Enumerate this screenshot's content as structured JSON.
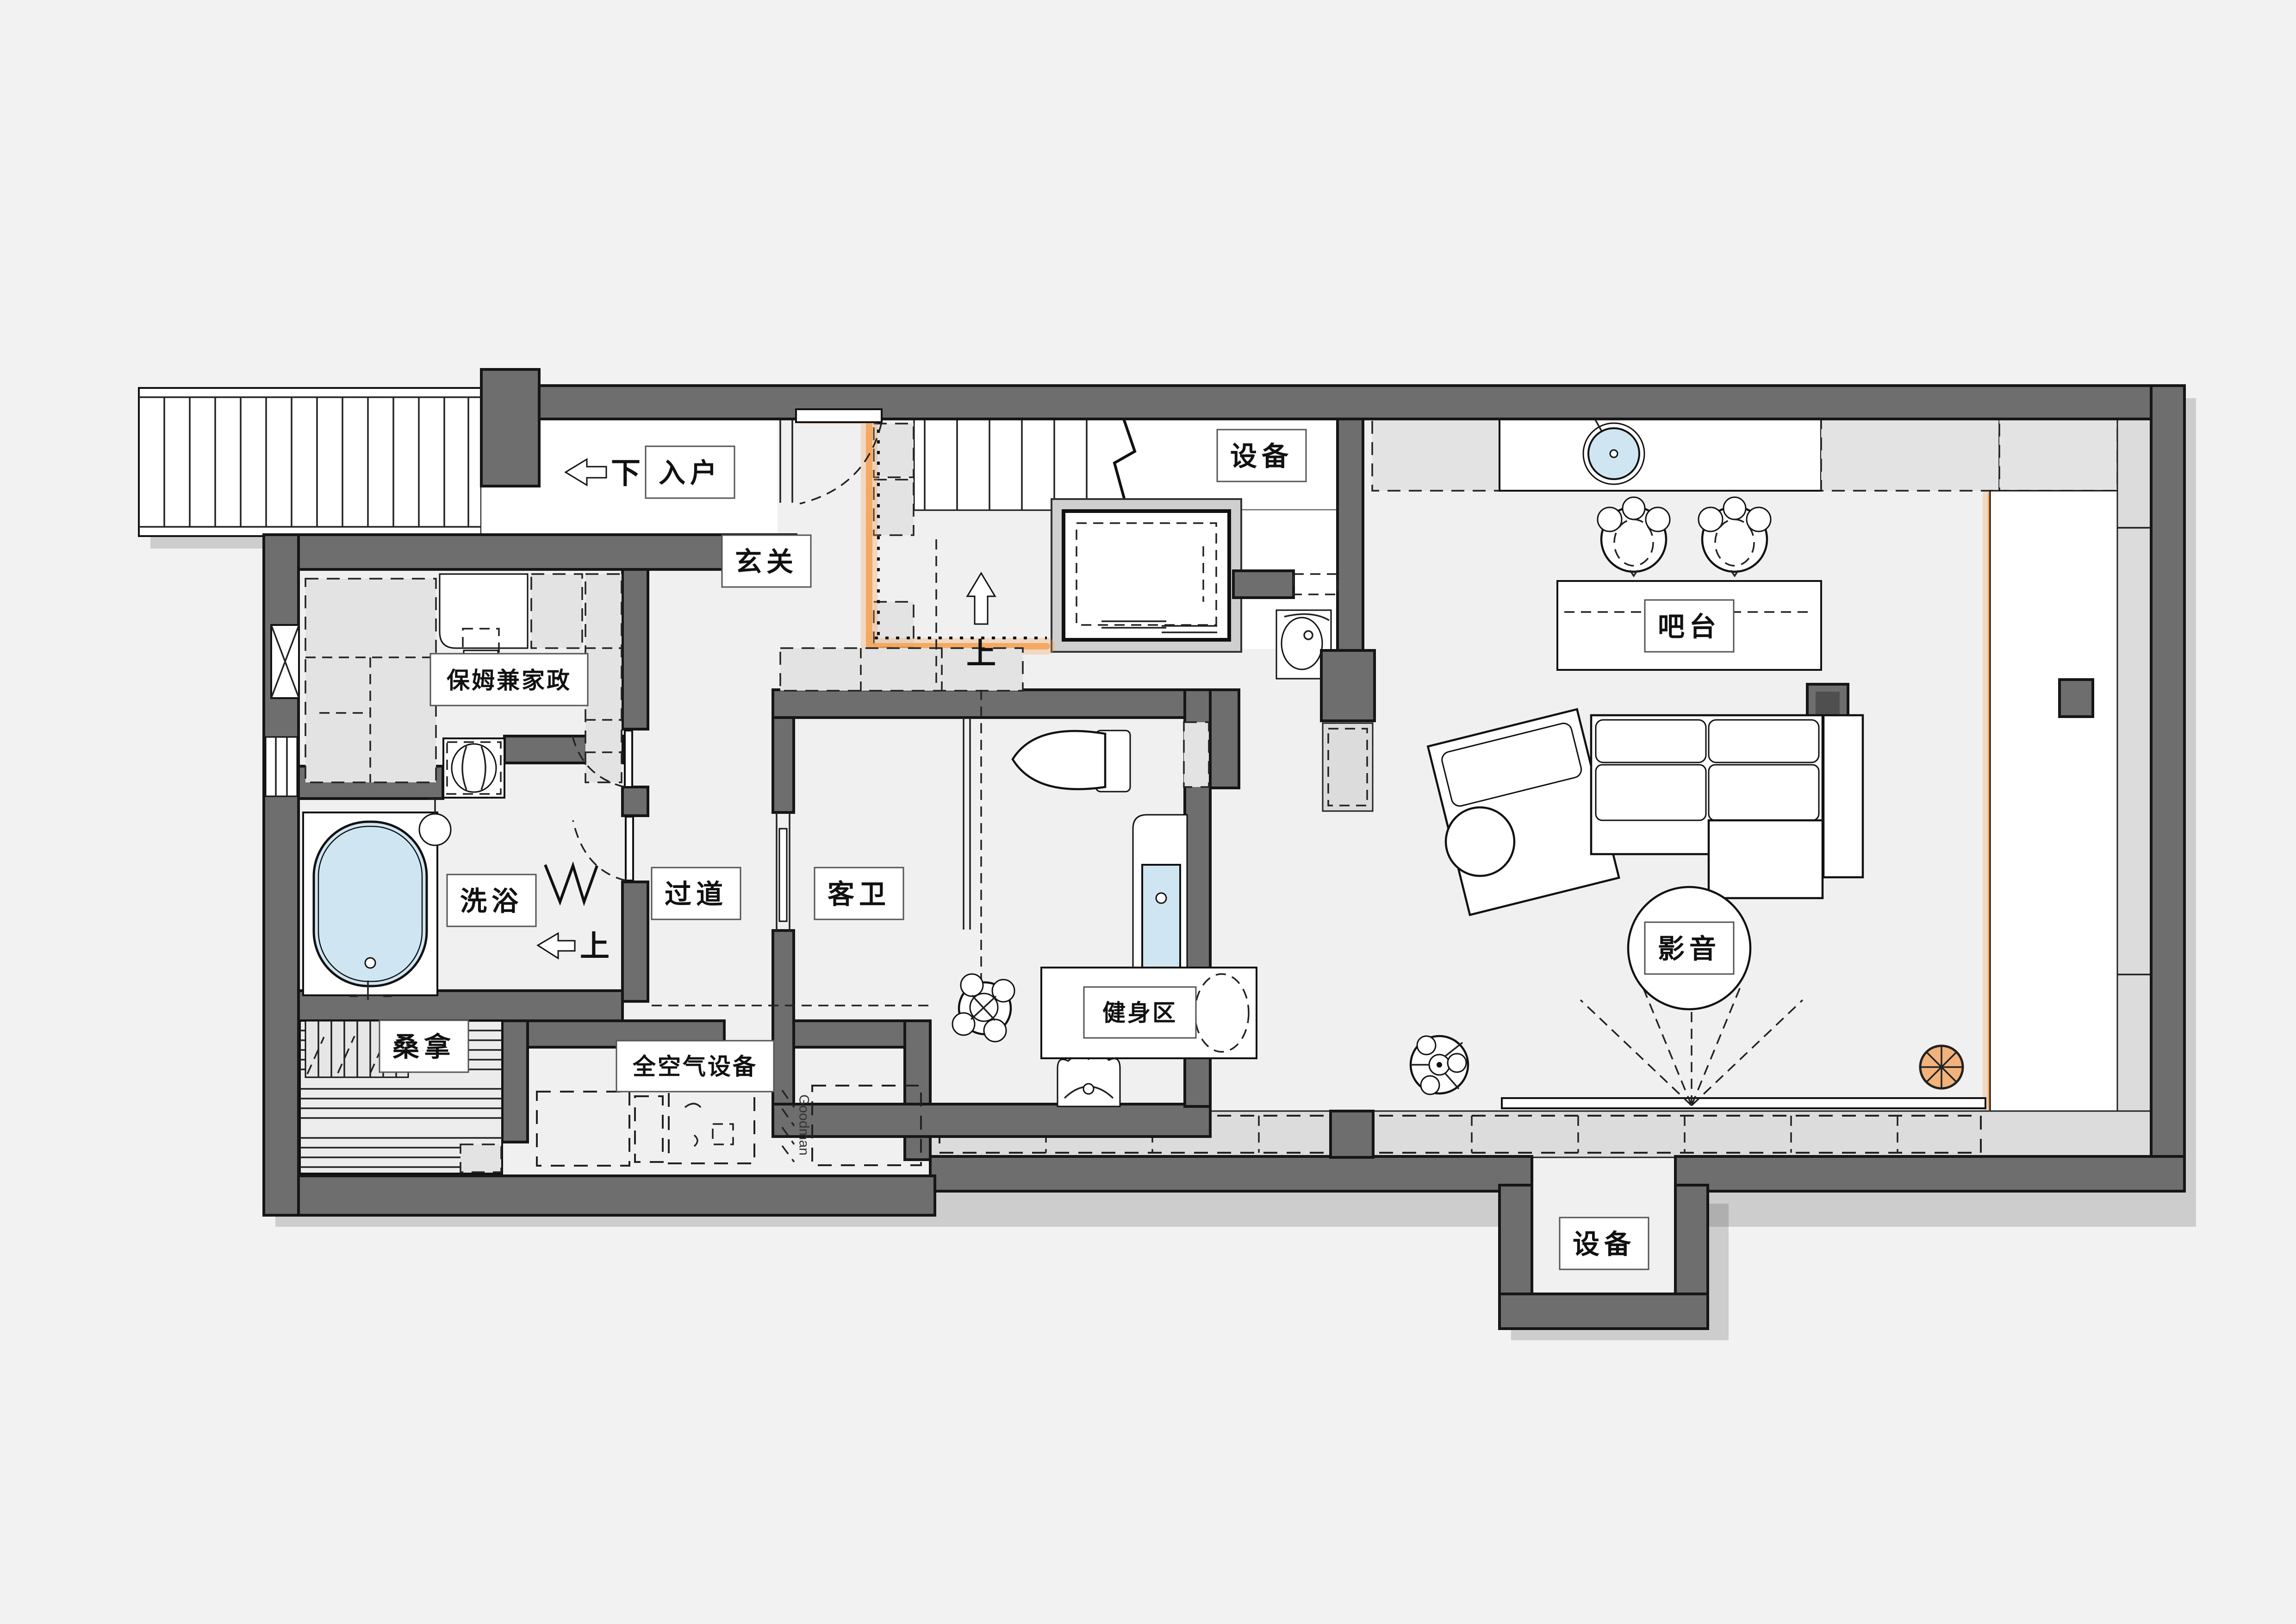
{
  "plan": {
    "type": "residential basement floor plan",
    "colors": {
      "wall_grey": "#6e6e6e",
      "accent_orange": "#f4a254",
      "water_blue": "#cfe6f2",
      "floor_grey": "#f0f0f1",
      "cabinet_grey": "#e3e3e3"
    },
    "labels": {
      "entry": "入户",
      "foyer": "玄关",
      "equipment_top": "设备",
      "nanny_housekeeping": "保姆兼家政",
      "bath": "洗浴",
      "corridor": "过道",
      "guest_bathroom": "客卫",
      "sauna": "桑拿",
      "air_equipment": "全空气设备",
      "fitness_area": "健身区",
      "bar_counter": "吧台",
      "media": "影音",
      "equipment_bottom": "设备",
      "brand": "Goodman"
    },
    "annotations": {
      "stairs_down": "下",
      "stairs_up": "上",
      "step_up": "上"
    },
    "icons": [
      "exterior-staircase",
      "interior-staircase",
      "elevator-shaft",
      "bathtub",
      "shower-tray",
      "shower-head",
      "folding-door-symbol",
      "toilet",
      "vanity-sink",
      "mop-basin",
      "washing-machine",
      "round-bar-sink",
      "bar-stool",
      "sectional-sofa",
      "round-side-table",
      "media-rug",
      "ceiling-fan",
      "projector-screen",
      "downlight-symbol",
      "bed",
      "desk",
      "chair",
      "wardrobe-cabinets",
      "hvac-units",
      "sauna-benches",
      "dumbbell-rack"
    ]
  }
}
